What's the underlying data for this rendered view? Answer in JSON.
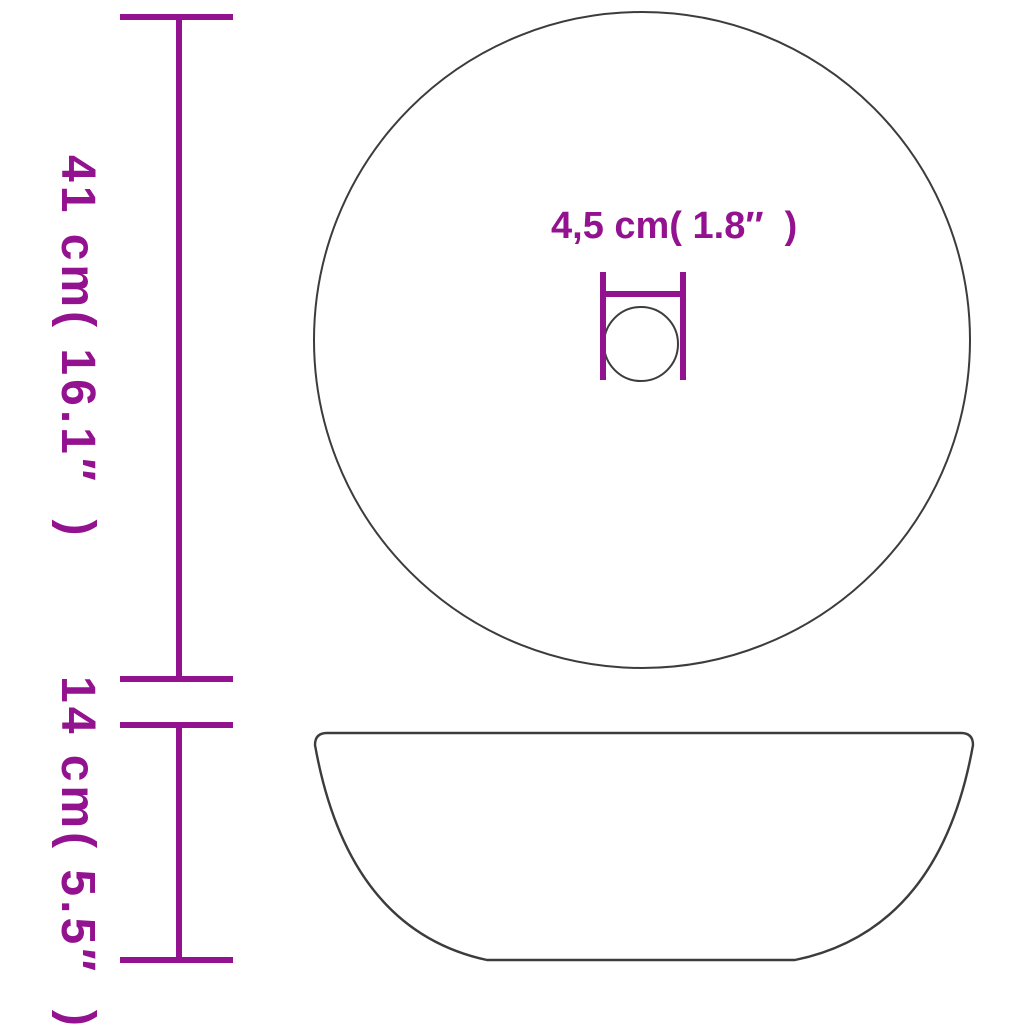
{
  "diagram": {
    "background_color": "#ffffff",
    "outline_color": "#3c3c3c",
    "dimension_color": "#93128f"
  },
  "labels": {
    "diameter": "41 cm( 16.1″  )",
    "height": "14 cm( 5.5″  )",
    "drain": "4,5 cm( 1.8″  )"
  }
}
